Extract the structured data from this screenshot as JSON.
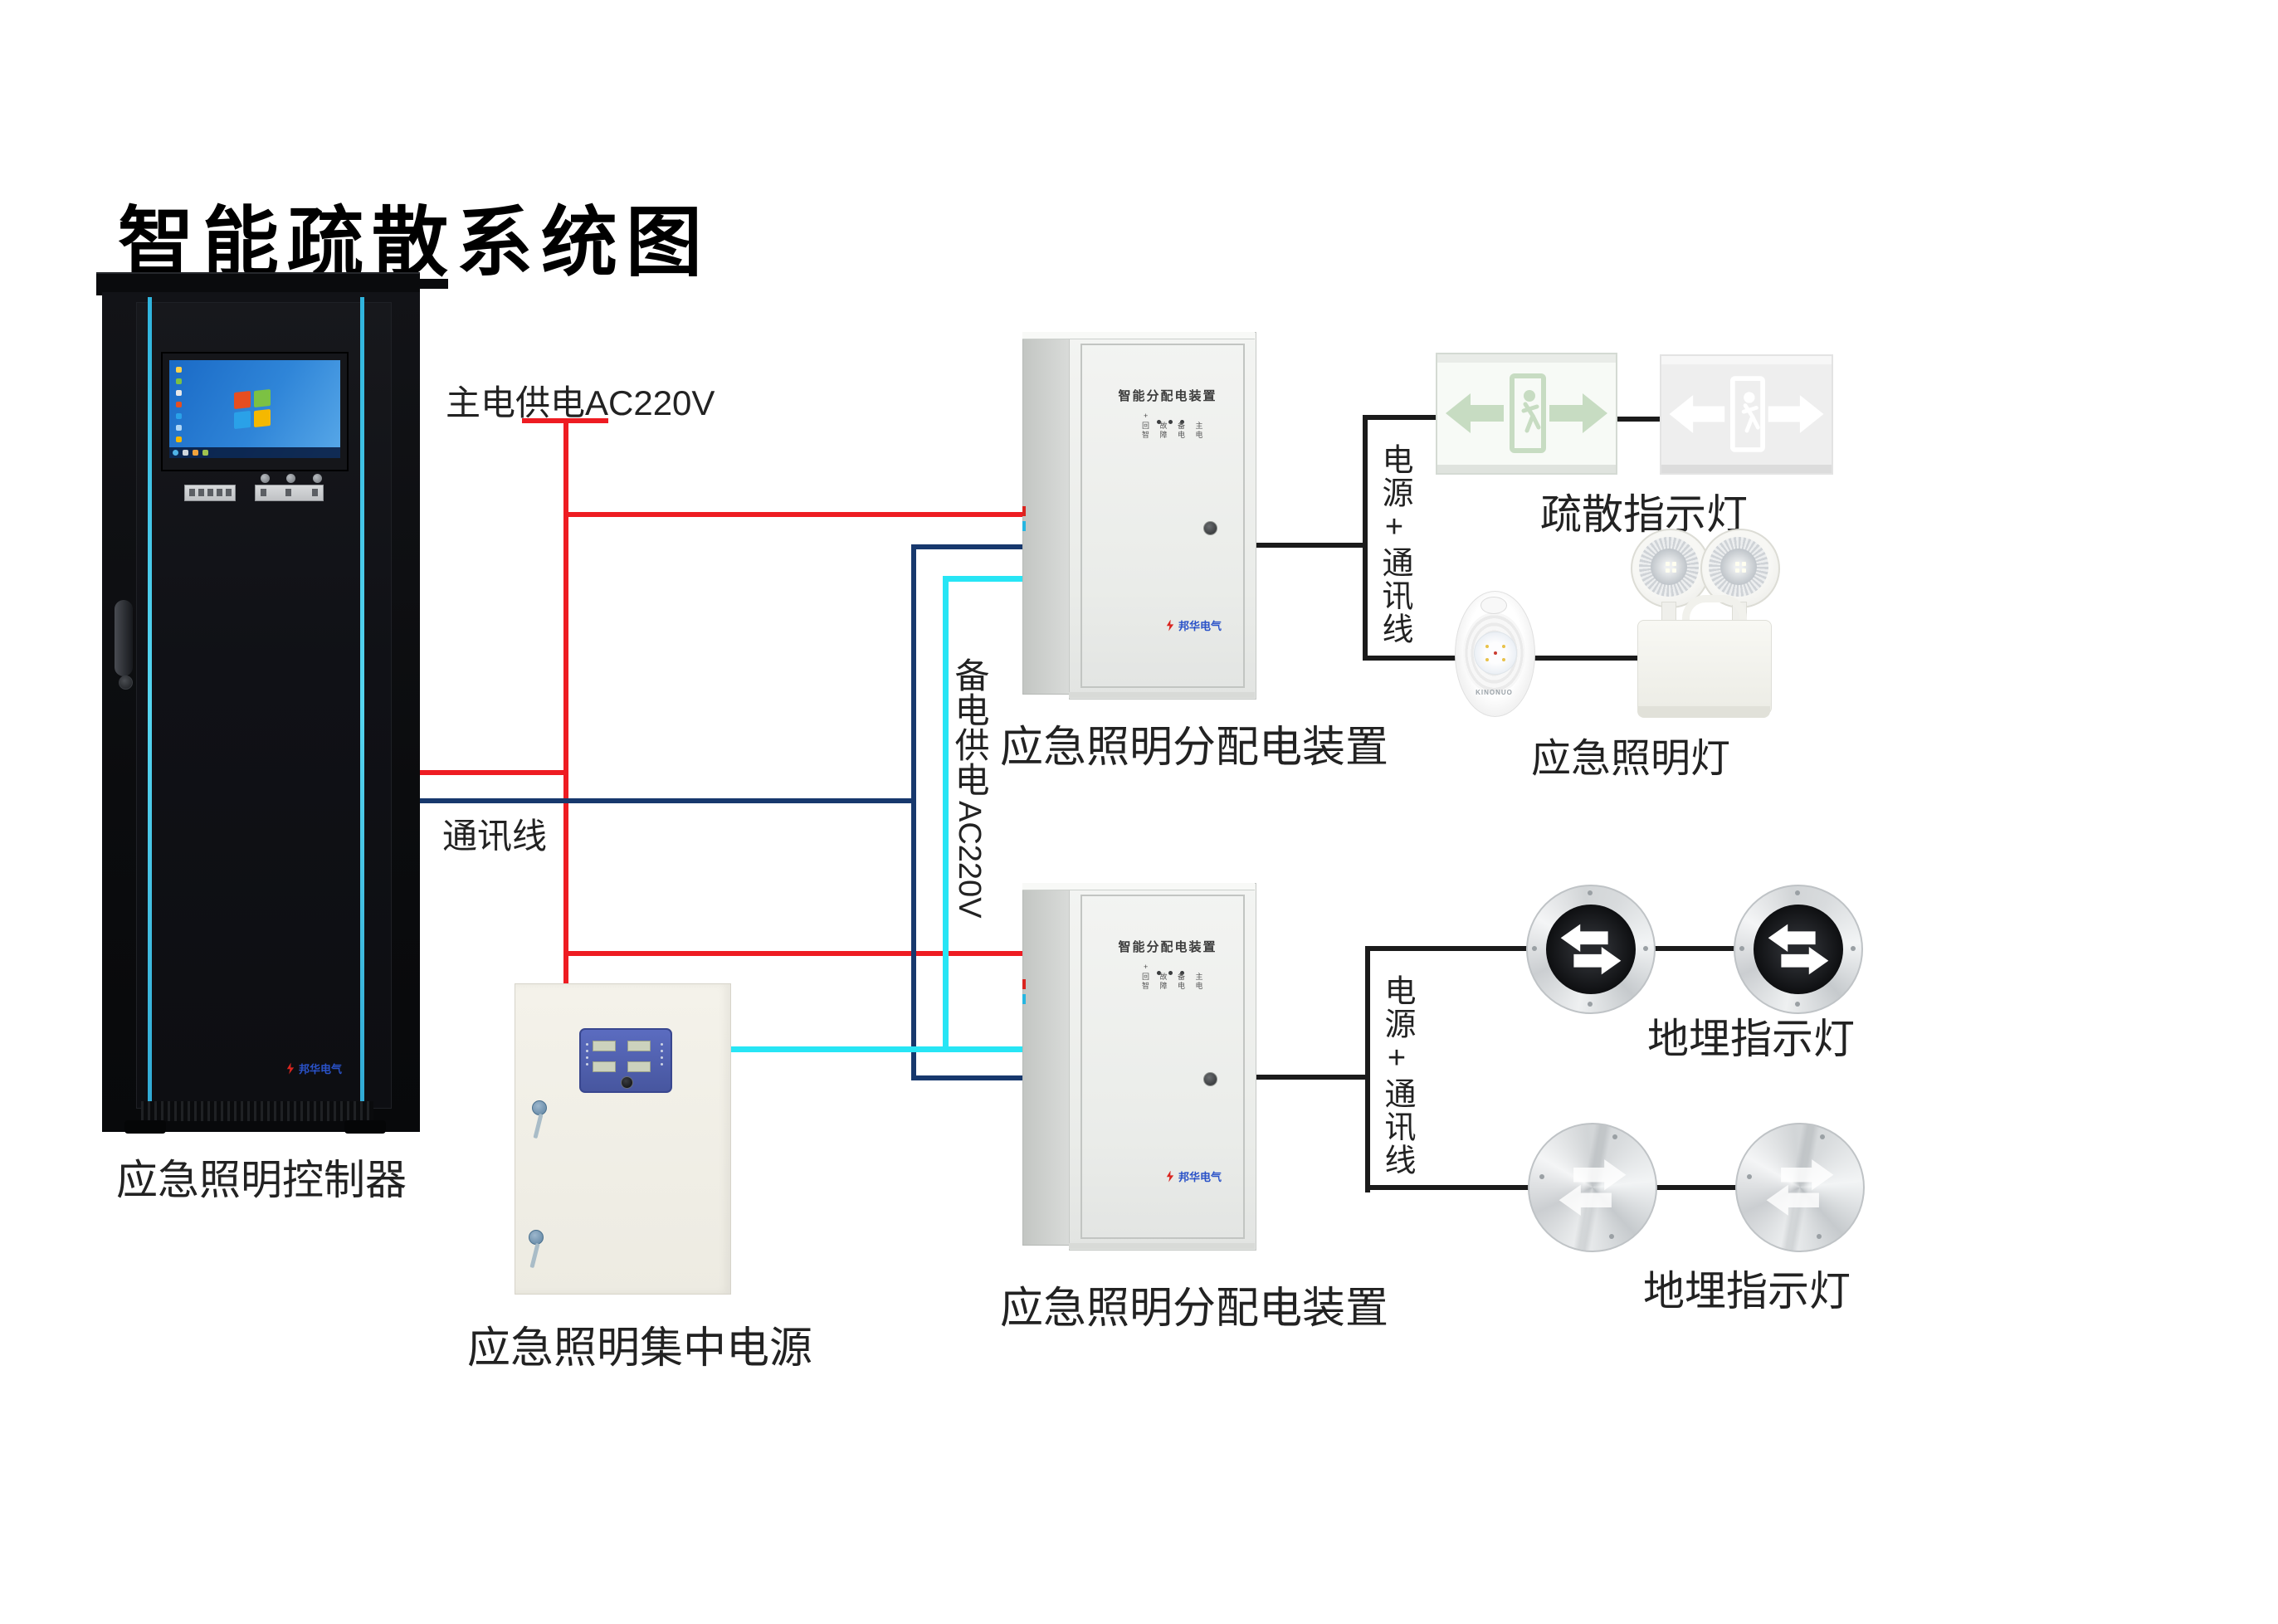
{
  "title": "智能疏散系统图",
  "colors": {
    "main_power_wire": "#ee1c22",
    "comm_wire": "#17386d",
    "backup_power_wire": "#27e5f5",
    "signal_wire": "#1b1b1b",
    "accent_cyan": "#3fc6e8",
    "panel_blue": "#5061b4"
  },
  "rack": {
    "label": "应急照明控制器",
    "brand": "邦华电气"
  },
  "power_cabinet": {
    "label": "应急照明集中电源"
  },
  "dist_box1": {
    "door_title": "智能分配电装置",
    "indicator_row1": "回 故 备 主",
    "indicator_row2": "智 障 电 电",
    "brand": "邦华电气",
    "label": "应急照明分配电装置"
  },
  "dist_box2": {
    "door_title": "智能分配电装置",
    "indicator_row1": "回 故 备 主",
    "indicator_row2": "智 障 电 电",
    "brand": "邦华电气",
    "label": "应急照明分配电装置"
  },
  "wire_labels": {
    "main_power": "主电供电AC220V",
    "comm": "通讯线",
    "backup_cn": "备电供电",
    "backup_ac": "AC220V",
    "power_comm": "电源+通讯线"
  },
  "exit_signs": {
    "label": "疏散指示灯"
  },
  "emergency_lights": {
    "label": "应急照明灯",
    "brand": "KINONUO"
  },
  "ground_lights_row1": {
    "label": "地埋指示灯"
  },
  "ground_lights_row2": {
    "label": "地埋指示灯"
  }
}
